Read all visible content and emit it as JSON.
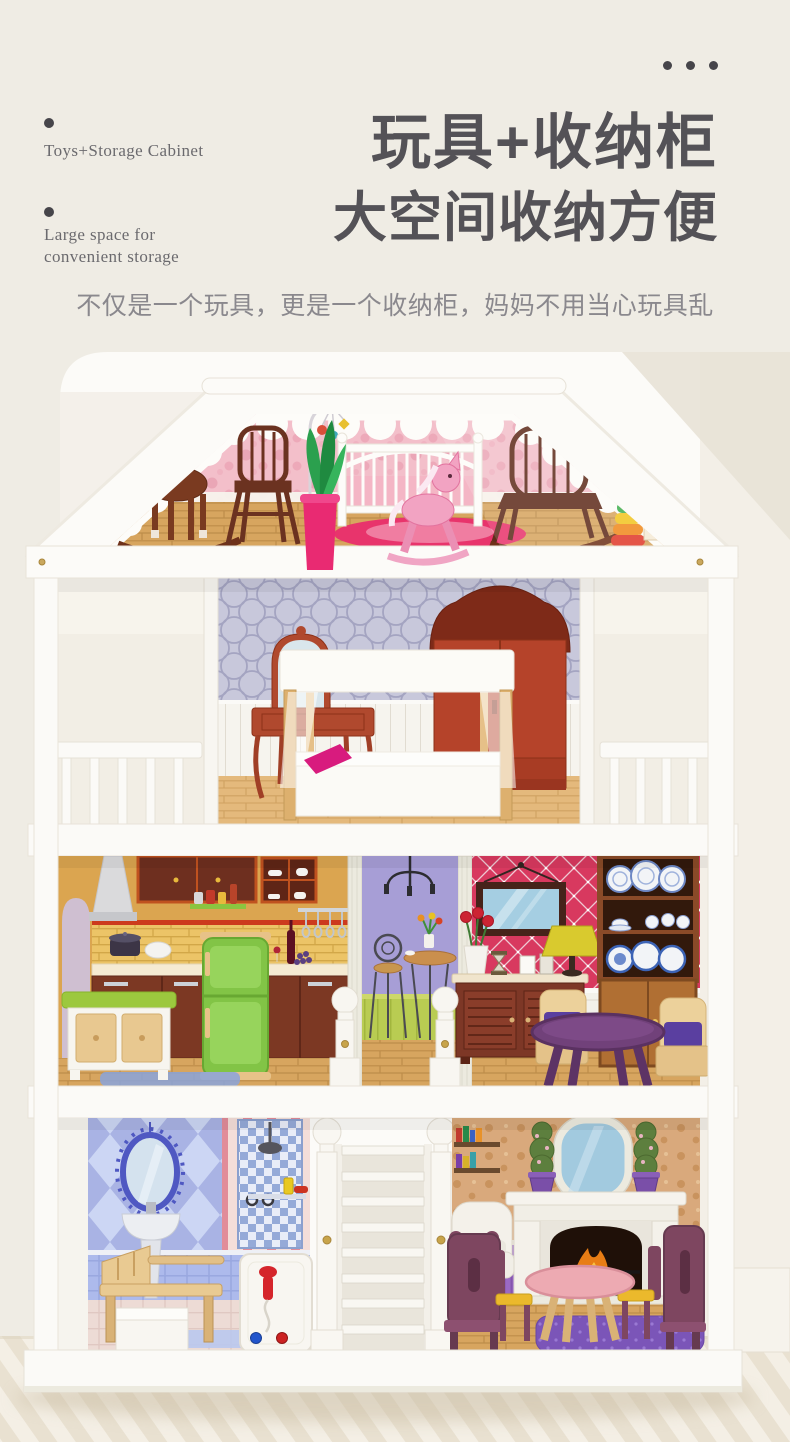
{
  "palette": {
    "page_background": "#efece4",
    "backdrop_white": "#fcfbf8",
    "house_white": "#fbfaf7",
    "title_text": "#545257",
    "body_text": "#6b6a6e",
    "subtitle_text": "#8a888d",
    "accent_pink": "#e8346c",
    "attic_pink": "#f3bfca",
    "bedroom_lavender": "#c8c8db",
    "kitchen_orange": "#dba550",
    "hallway_purple": "#a79ed6",
    "living_crimson": "#d8395f",
    "bathroom_blue": "#a9b3e4",
    "parlor_tan": "#d9a97c",
    "fridge_green": "#82c446",
    "wood_floor": "#d7a55f"
  },
  "header": {
    "menu_icon": "ellipsis",
    "features": [
      {
        "lines": [
          "Toys+Storage Cabinet"
        ]
      },
      {
        "lines": [
          "Large space for",
          "convenient storage"
        ]
      }
    ],
    "title_line1": "玩具+收纳柜",
    "title_line2": "大空间收纳方便",
    "subtitle": "不仅是一个玩具，更是一个收纳柜，妈妈不用当心玩具乱"
  },
  "photo": {
    "block_letter": "A"
  }
}
